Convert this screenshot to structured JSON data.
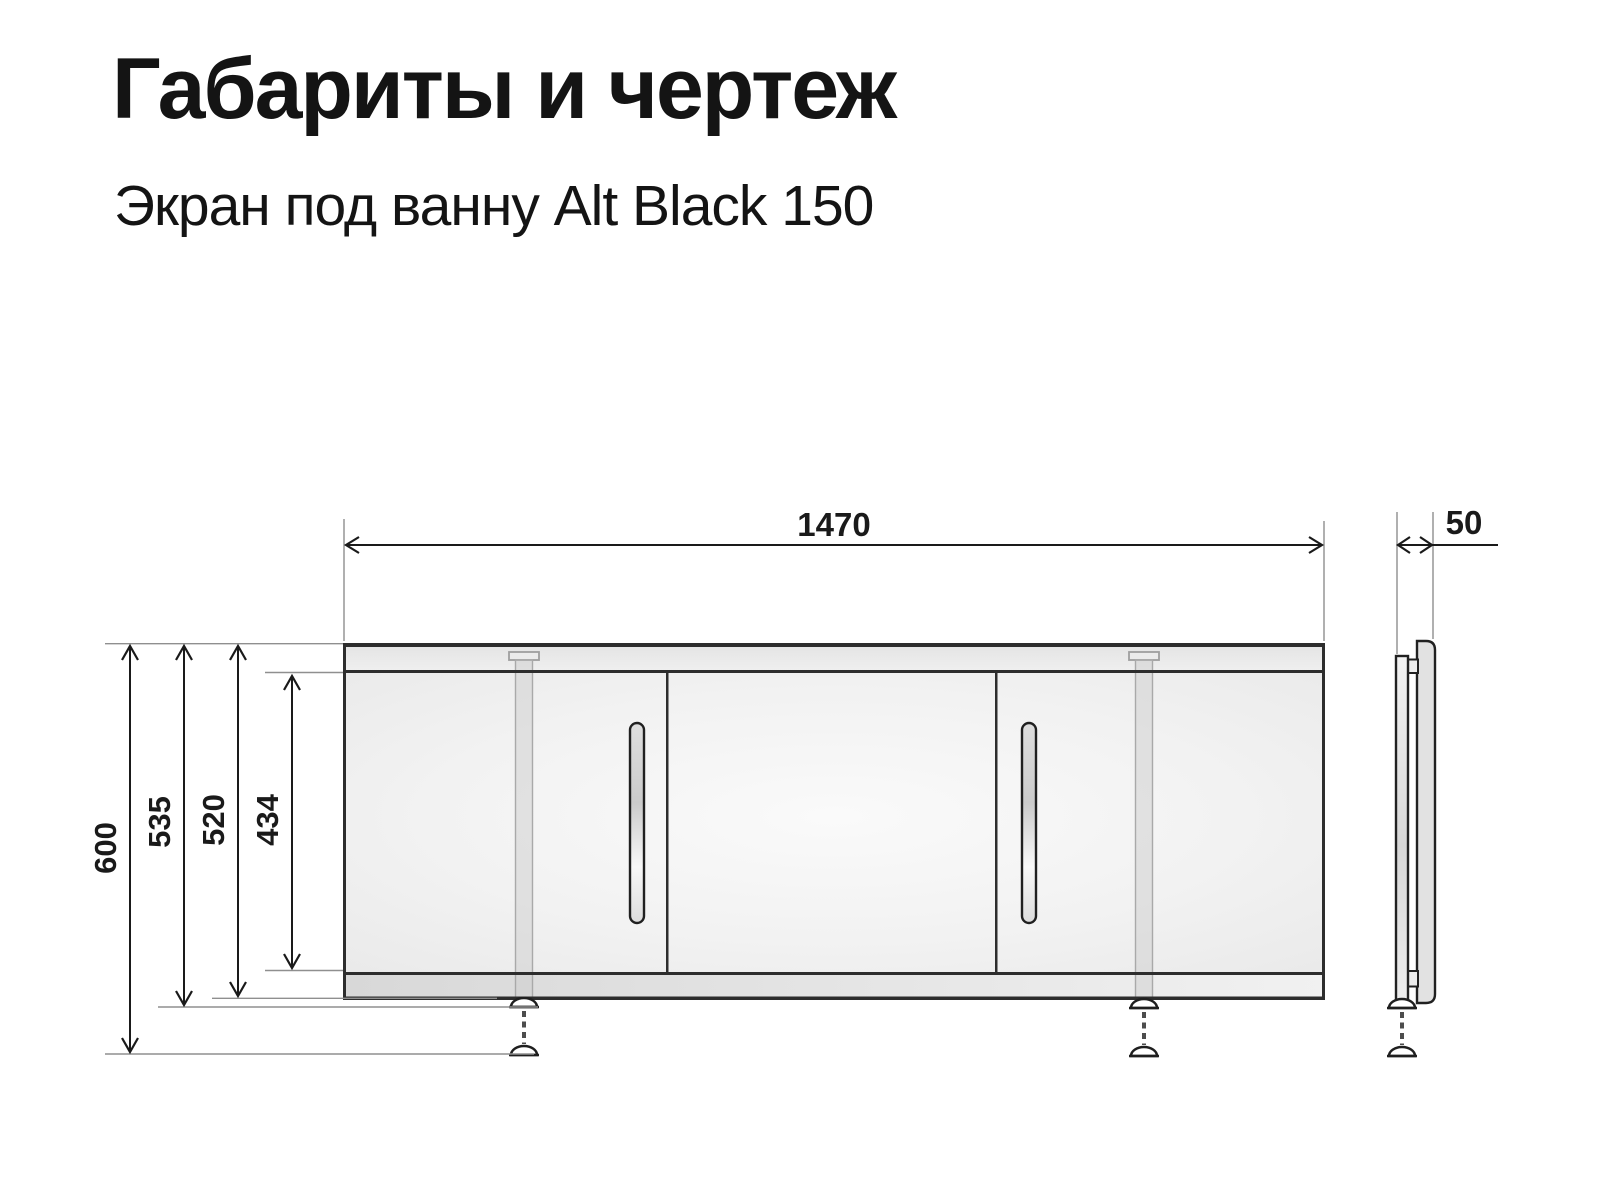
{
  "header": {
    "title": "Габариты и чертеж",
    "subtitle": "Экран под ванну Alt Black 150"
  },
  "dimensions": {
    "width": "1470",
    "depth": "50",
    "total_height": "600",
    "height_with_feet": "535",
    "panel_height": "520",
    "body_height": "434"
  },
  "colors": {
    "outline": "#2d2d2d",
    "dimension_line": "#1a1a1a",
    "extension_line": "#8f8f8f",
    "panel_body_fill": "#f1f1f1",
    "rail_fill": "#e6e6e6",
    "text": "#141414",
    "background": "#ffffff"
  }
}
